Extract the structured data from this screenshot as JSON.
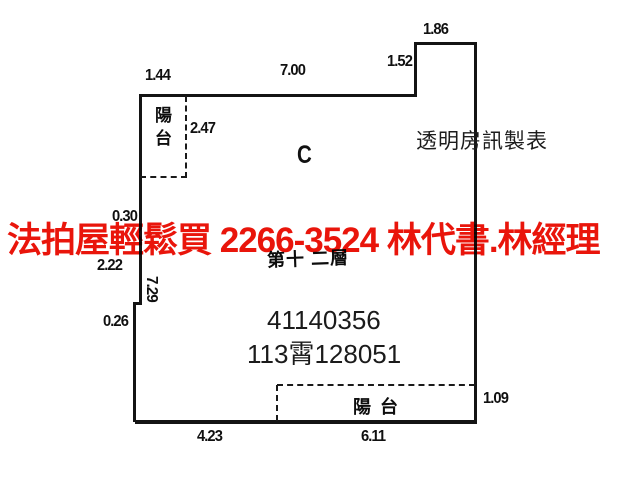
{
  "watermark": {
    "text": "法拍屋輕鬆買  2266-3524  林代書.林經理",
    "color": "#e9150b"
  },
  "plan": {
    "unit_label": "C",
    "maker_label": "透明房訊製表",
    "floor_label": "第十 二層",
    "building_number": "41140356",
    "registry_number": "113霄128051",
    "balcony_top_label": "陽台",
    "balcony_bottom_label": "陽台",
    "dimensions": [
      {
        "id": "top-balcony-width",
        "text": "1.44"
      },
      {
        "id": "top-main-width",
        "text": "7.00"
      },
      {
        "id": "top-step-width",
        "text": "1.86"
      },
      {
        "id": "top-step-height",
        "text": "1.52"
      },
      {
        "id": "balcony-top-depth",
        "text": "2.47"
      },
      {
        "id": "left-upper-step",
        "text": "0.30"
      },
      {
        "id": "left-mid",
        "text": "2.22"
      },
      {
        "id": "left-long",
        "text": "7.29"
      },
      {
        "id": "left-small-step",
        "text": "0.26"
      },
      {
        "id": "bottom-left-width",
        "text": "4.23"
      },
      {
        "id": "bottom-balcony-width",
        "text": "6.11"
      },
      {
        "id": "bottom-balcony-depth",
        "text": "1.09"
      }
    ],
    "line_color": "#141414"
  }
}
